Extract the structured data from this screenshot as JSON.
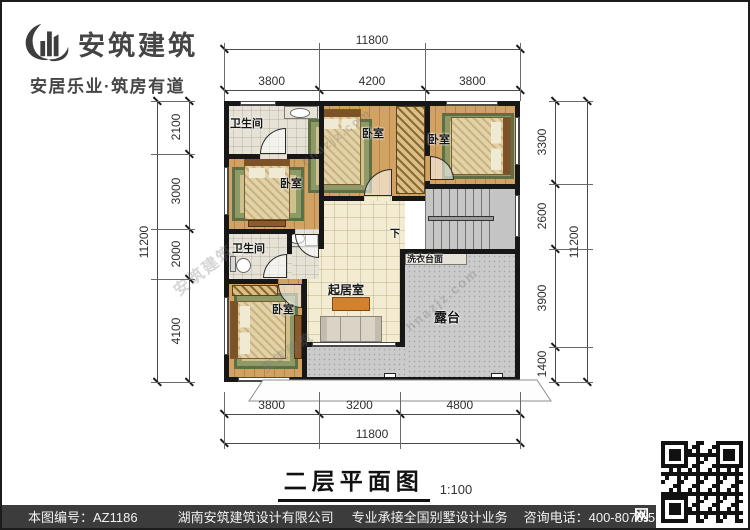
{
  "brand": {
    "icon": "building-swoosh-icon",
    "name": "安筑建筑",
    "tagline": "安居乐业·筑房有道"
  },
  "plan": {
    "labels": {
      "bath_top": "卫生间",
      "bath_lower": "卫生间",
      "bedroom_left": "卧室",
      "bedroom_top_mid": "卧室",
      "bedroom_top_right": "卧室",
      "bedroom_bottom": "卧室",
      "living": "起居室",
      "laundry": "洗衣台面",
      "terrace": "露台",
      "stairs_down": "下"
    }
  },
  "dims": {
    "top": {
      "total": "11800",
      "segments": [
        "3800",
        "4200",
        "3800"
      ]
    },
    "bottom": {
      "total": "11800",
      "segments": [
        "3800",
        "3200",
        "4800"
      ]
    },
    "left": {
      "total": "11200",
      "segments": [
        "2100",
        "3000",
        "2000",
        "4100"
      ]
    },
    "right": {
      "total": "11200",
      "segments": [
        "3300",
        "2600",
        "3900",
        "1400"
      ]
    }
  },
  "title": {
    "text": "二层平面图",
    "scale": "1:100"
  },
  "watermarks": [
    "安筑建筑",
    "hnazjz.com",
    "hnazjz.com",
    "安筑建筑"
  ],
  "footer": {
    "doc_no": "本图编号：AZ1186",
    "company": "湖南安筑建筑设计有限公司",
    "service": "专业承接全国别墅设计业务",
    "phone": "咨询电话：400-8070-511",
    "web": "网"
  }
}
